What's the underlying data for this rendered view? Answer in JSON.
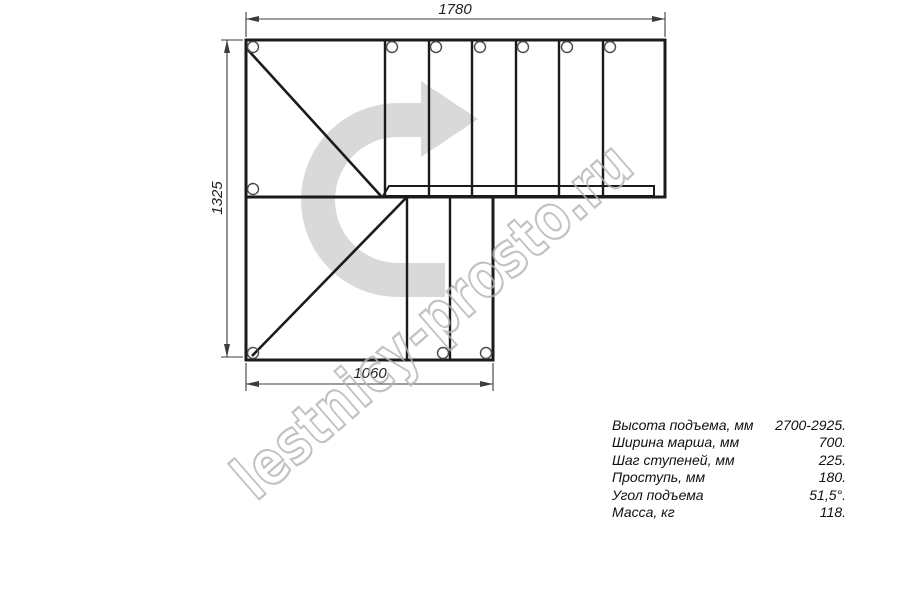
{
  "drawing": {
    "type": "staircase-plan-top-view",
    "dimensions": {
      "top_width_mm": "1780",
      "left_height_mm": "1325",
      "bottom_width_mm": "1060"
    },
    "watermark": {
      "text": "lestnicy-prosto.ru",
      "color": "#b3b3b3"
    },
    "icons": {
      "direction_arrow": "curved-arrow-turn-right"
    },
    "colors": {
      "outline": "#1b1b1b",
      "dimension_lines": "#3c3c3c",
      "arrow_fill": "#d9d9d9",
      "background": "#ffffff"
    }
  },
  "specs": {
    "rows": [
      {
        "label": "Высота подъема, мм",
        "value": "2700-2925."
      },
      {
        "label": "Ширина марша, мм",
        "value": "700."
      },
      {
        "label": "Шаг ступеней, мм",
        "value": "225."
      },
      {
        "label": "Проступь, мм",
        "value": "180."
      },
      {
        "label": "Угол подъема",
        "value": "51,5°."
      },
      {
        "label": "Масса, кг",
        "value": "118."
      }
    ]
  }
}
